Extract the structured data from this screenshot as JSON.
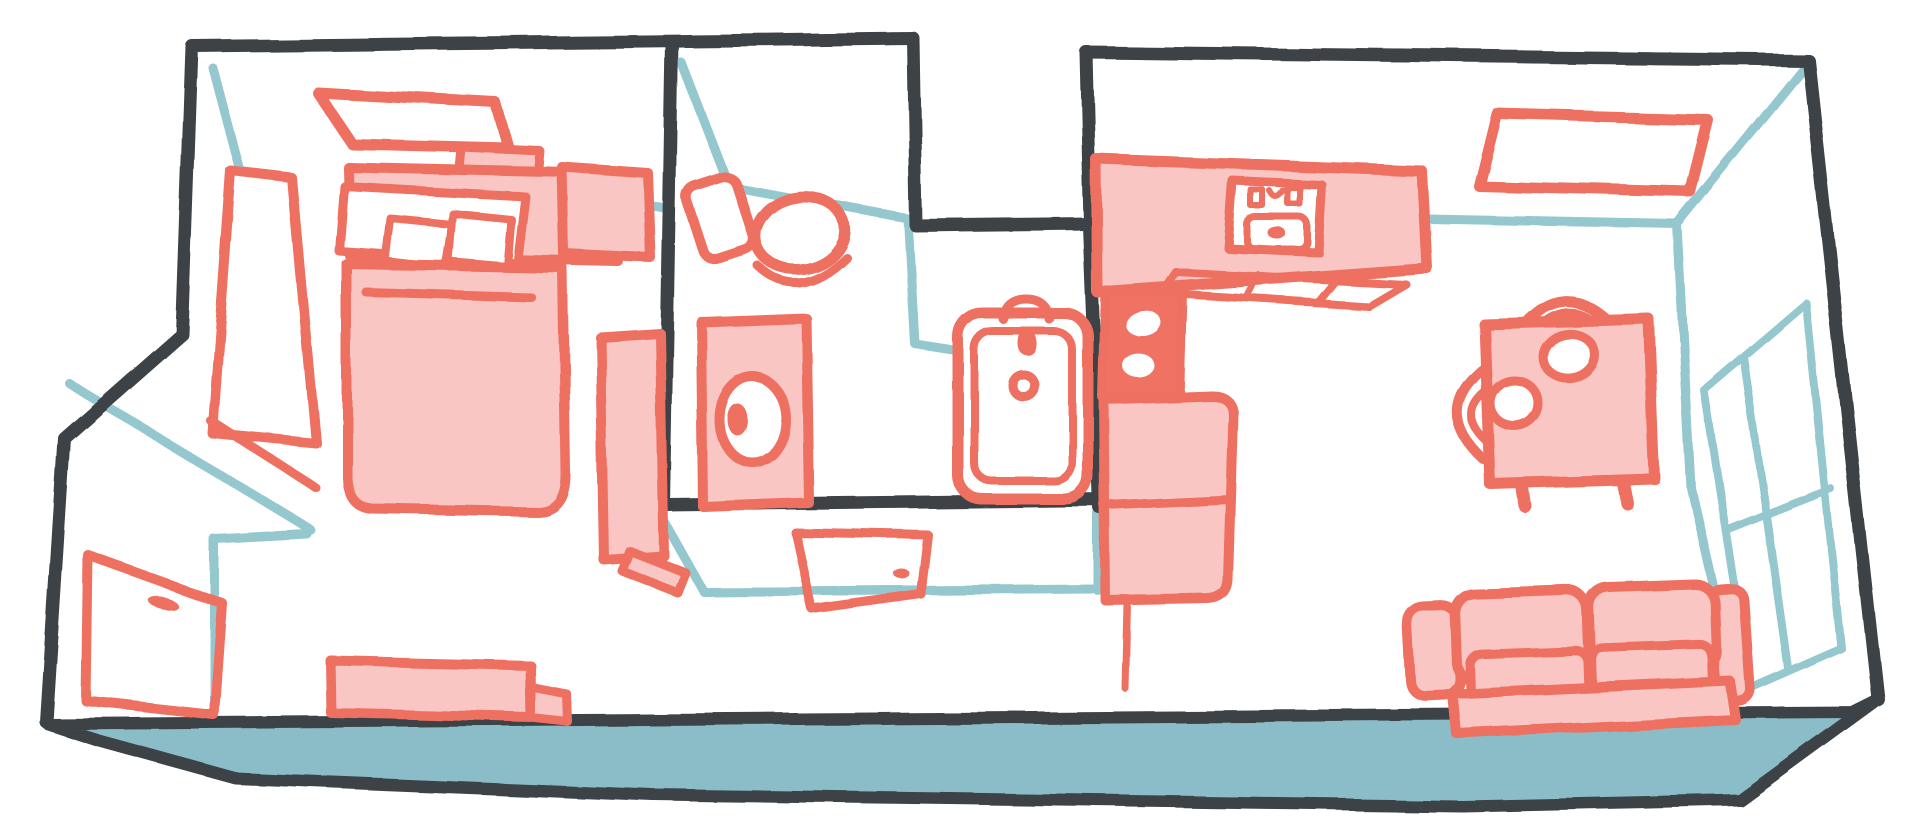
{
  "scene": {
    "type": "floor-plan-illustration",
    "style": "hand-drawn crayon sketch, axonometric top-down apartment floor plan, no text labels",
    "rooms": [
      {
        "name": "bedroom",
        "position": "top-left",
        "furniture": [
          "skylight-window",
          "wardrobe-with-open-door",
          "headboard-shelf",
          "bed-with-pillows",
          "nightstand",
          "bench"
        ]
      },
      {
        "name": "entrance-hall",
        "position": "bottom-left",
        "furniture": [
          "front-door-with-handle",
          "wall-step"
        ]
      },
      {
        "name": "bathroom",
        "position": "top-center",
        "furniture": [
          "toilet",
          "washing-machine",
          "bathtub-with-faucet-and-drain",
          "open-door-with-handle",
          "tall-cabinet"
        ]
      },
      {
        "name": "kitchen",
        "position": "center-right",
        "furniture": [
          "counter-with-sink",
          "cabinet-front",
          "two-burner-stove",
          "refrigerator"
        ]
      },
      {
        "name": "living-room",
        "position": "right",
        "furniture": [
          "skylight-window",
          "dining-table",
          "plates",
          "chairs",
          "sofa",
          "tall-window-panes"
        ]
      }
    ],
    "outline_features": [
      "notch-recess-top-center",
      "stepped-left-wall",
      "teal-floor-slab-edge-bottom"
    ]
  },
  "palette": {
    "wall": "#3e4347",
    "line": "#95c7cf",
    "floor": "#8abdc8",
    "pink": "#ee6f60",
    "pink_light": "#f9c6c3",
    "pink_solid": "#ef7264",
    "white": "#ffffff",
    "background": "#ffffff"
  }
}
